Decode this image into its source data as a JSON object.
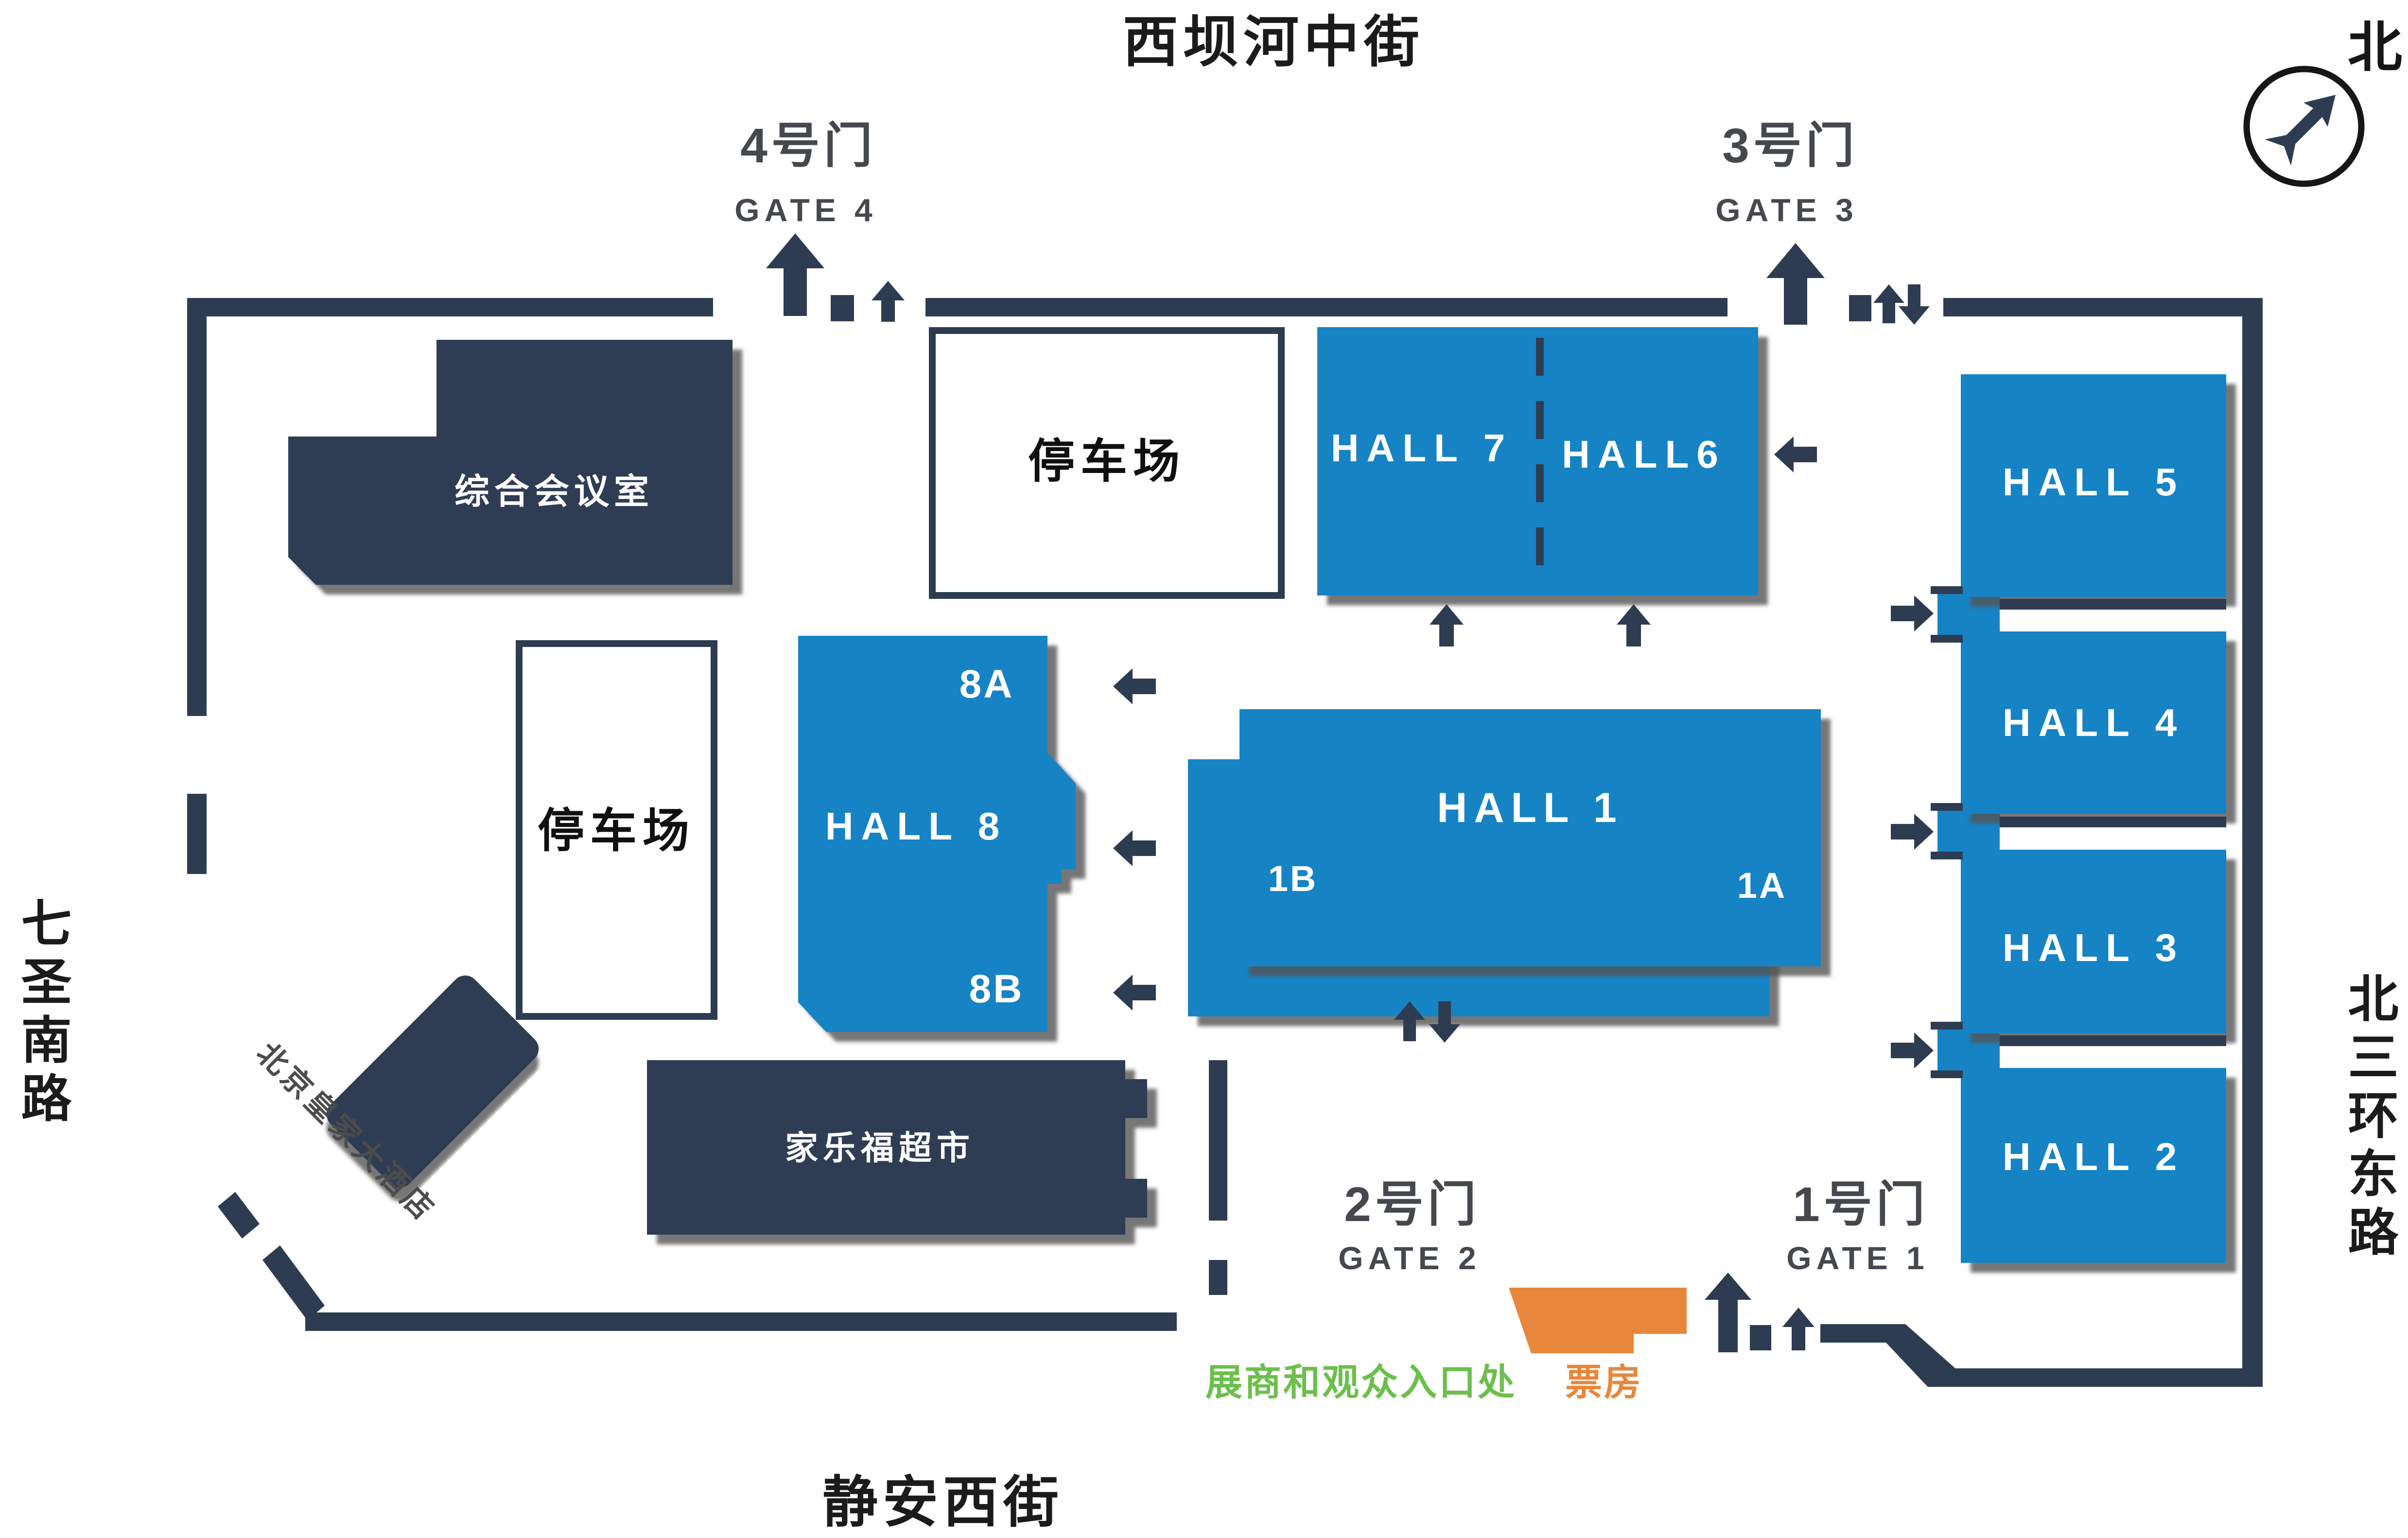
{
  "streets": {
    "north": "西坝河中街",
    "west": "七圣南路",
    "east": "北三环东路",
    "south": "静安西街"
  },
  "compass": {
    "label": "北"
  },
  "gates": {
    "gate4": {
      "cn": "4号门",
      "en": "GATE 4"
    },
    "gate3": {
      "cn": "3号门",
      "en": "GATE 3"
    },
    "gate2": {
      "cn": "2号门",
      "en": "GATE 2"
    },
    "gate1": {
      "cn": "1号门",
      "en": "GATE 1"
    }
  },
  "halls": {
    "hall7": "HALL 7",
    "hall6": "HALL6",
    "hall5": "HALL 5",
    "hall4": "HALL 4",
    "hall3": "HALL 3",
    "hall2": "HALL 2",
    "hall1": "HALL 1",
    "hall1a": "1A",
    "hall1b": "1B",
    "hall8": "HALL 8",
    "hall8a": "8A",
    "hall8b": "8B"
  },
  "facilities": {
    "conference_room": "综合会议室",
    "parking_north": "停车场",
    "parking_west": "停车场",
    "supermarket": "家乐福超市",
    "hotel": "北京皇家大酒店"
  },
  "entrance_info": {
    "visitor_entrance": "展商和观众入口处",
    "box_office": "票房"
  },
  "colors": {
    "hall_blue": "#1683c4",
    "wall_navy": "#2e3c52",
    "entrance_green": "#6cbf4b",
    "box_office_orange": "#e8873b"
  }
}
